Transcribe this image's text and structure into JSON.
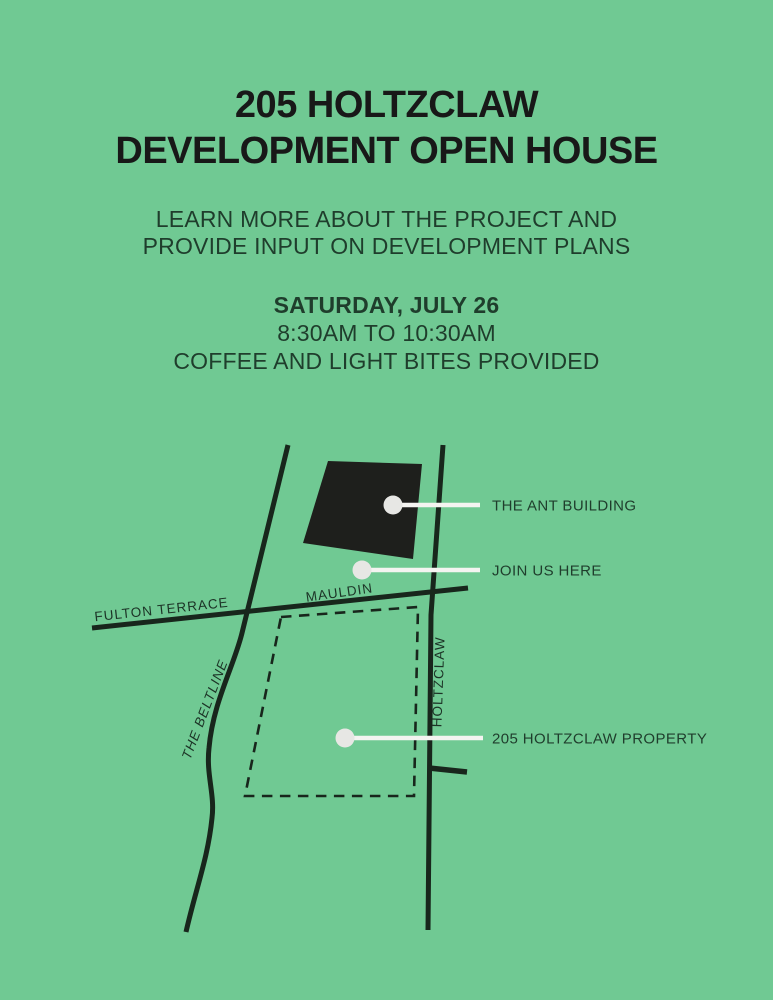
{
  "page": {
    "background": "#70c993"
  },
  "title": {
    "line1": "205 HOLTZCLAW",
    "line2": "DEVELOPMENT OPEN HOUSE"
  },
  "intro": {
    "line1": "LEARN MORE ABOUT THE PROJECT AND",
    "line2": "PROVIDE INPUT ON DEVELOPMENT PLANS"
  },
  "event": {
    "date": "SATURDAY, JULY 26",
    "time": "8:30AM TO 10:30AM",
    "note": "COFFEE AND LIGHT BITES PROVIDED"
  },
  "map": {
    "roads": {
      "fulton_terrace": "FULTON TERRACE",
      "mauldin": "MAULDIN",
      "beltline": "THE BELTLINE",
      "holtzclaw": "HOLTZCLAW"
    },
    "callouts": [
      {
        "label": "THE ANT BUILDING"
      },
      {
        "label": "JOIN US HERE"
      },
      {
        "label": "205 HOLTZCLAW PROPERTY"
      }
    ],
    "colors": {
      "road": "#18261c",
      "building": "#1e1f1c",
      "property_outline": "#18261c",
      "leader_line": "#f4f4f1",
      "marker_dot": "#e7e7e4",
      "label": "#1f3d2c"
    }
  }
}
